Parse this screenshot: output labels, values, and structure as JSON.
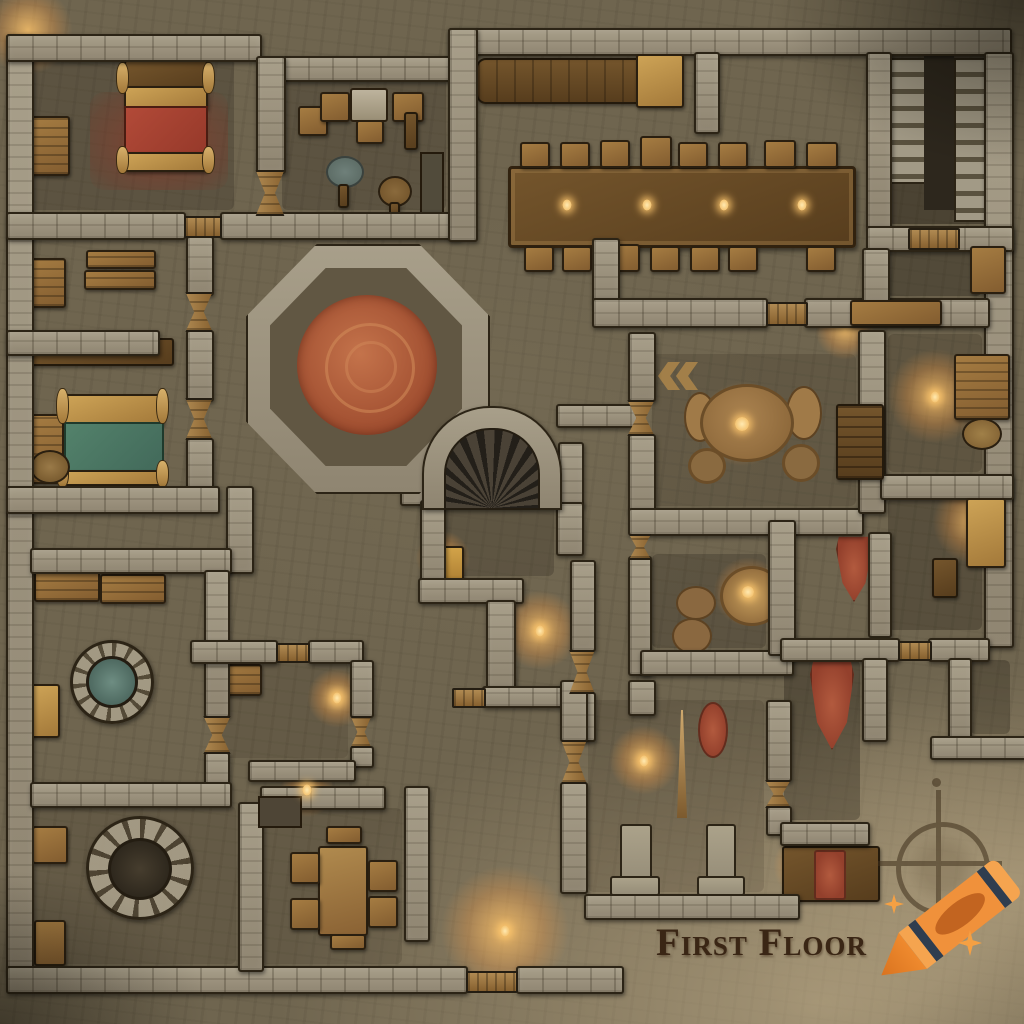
{
  "map": {
    "floor_label": "First Floor"
  },
  "watermark": {
    "logo": "crayon-icon",
    "sparkle_count": 2,
    "crayon_body_color": "#F0913B",
    "crayon_band_color": "#2F3D4F",
    "sparkle_color": "#F5A043"
  },
  "compass": {
    "icon": "compass-rose-icon",
    "color": "#3F301C"
  },
  "palette": {
    "floor": "#6F654F",
    "wall_stone": "#9D947F",
    "outline": "#2C2416",
    "parchment": "#C9B490",
    "bed_red": "#A84434",
    "carpet_red": "#8D3A2A",
    "bed_green": "#4D7A64",
    "rug_orange": "#BF6F48",
    "wood": "#8A6234",
    "gold_wood": "#C9A055",
    "candle_glow": "#FFC46A",
    "water_teal": "#5D7A70",
    "banner_red": "#9A3F2E"
  },
  "features": {
    "rooms": [
      "bedchamber with red bed, red carpet and cabinet",
      "storeroom with crates and two round tables",
      "great hall with long dining table, four candles, stools and wall bench",
      "double staircase in top-right corner",
      "shelf room and bedchamber with green bed",
      "octagonal chamber with round orange rug",
      "hearth alcove with arched fireplace and gold rug",
      "round-table chamber with chevron floor mark",
      "candlelit study with desk and pot",
      "well room with water well and benches",
      "dry well chamber with crates",
      "small dining room with table and four chairs",
      "pillared hall with spear and red oval rug",
      "bottom-right rooms with red banner rugs and side table"
    ]
  }
}
